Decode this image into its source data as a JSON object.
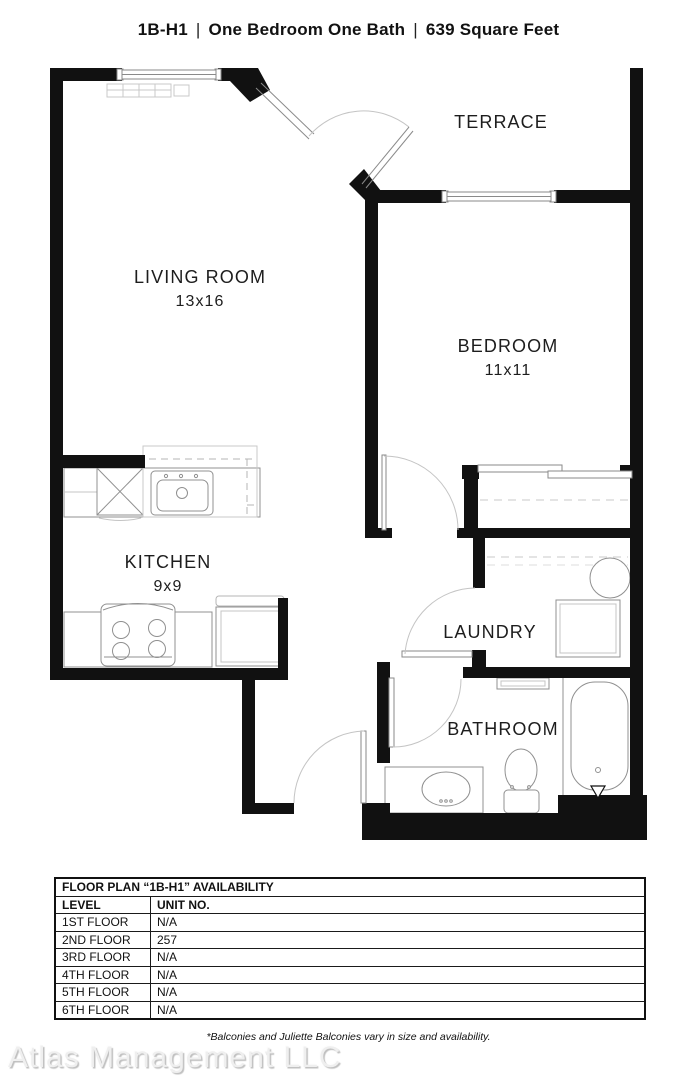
{
  "title": {
    "code": "1B-H1",
    "separator": "|",
    "description": "One Bedroom One Bath",
    "area": "639 Square Feet"
  },
  "rooms": {
    "living_room": {
      "name": "LIVING ROOM",
      "dims": "13x16"
    },
    "bedroom": {
      "name": "BEDROOM",
      "dims": "11x11"
    },
    "kitchen": {
      "name": "KITCHEN",
      "dims": "9x9"
    },
    "terrace": {
      "name": "TERRACE"
    },
    "laundry": {
      "name": "LAUNDRY"
    },
    "bathroom": {
      "name": "BATHROOM"
    }
  },
  "availability_table": {
    "title": "FLOOR PLAN “1B-H1” AVAILABILITY",
    "columns": [
      "LEVEL",
      "UNIT NO."
    ],
    "rows": [
      {
        "level": "1ST FLOOR",
        "unit": "N/A"
      },
      {
        "level": "2ND FLOOR",
        "unit": "257"
      },
      {
        "level": "3RD FLOOR",
        "unit": "N/A"
      },
      {
        "level": "4TH FLOOR",
        "unit": "N/A"
      },
      {
        "level": "5TH FLOOR",
        "unit": "N/A"
      },
      {
        "level": "6TH FLOOR",
        "unit": "N/A"
      }
    ]
  },
  "footnote": "*Balconies and Juliette Balconies vary in size and availability.",
  "watermark": "Atlas Management LLC",
  "colors": {
    "wall": "#111111",
    "fixture_stroke": "#909090",
    "watermark": "#e0e0e0"
  }
}
